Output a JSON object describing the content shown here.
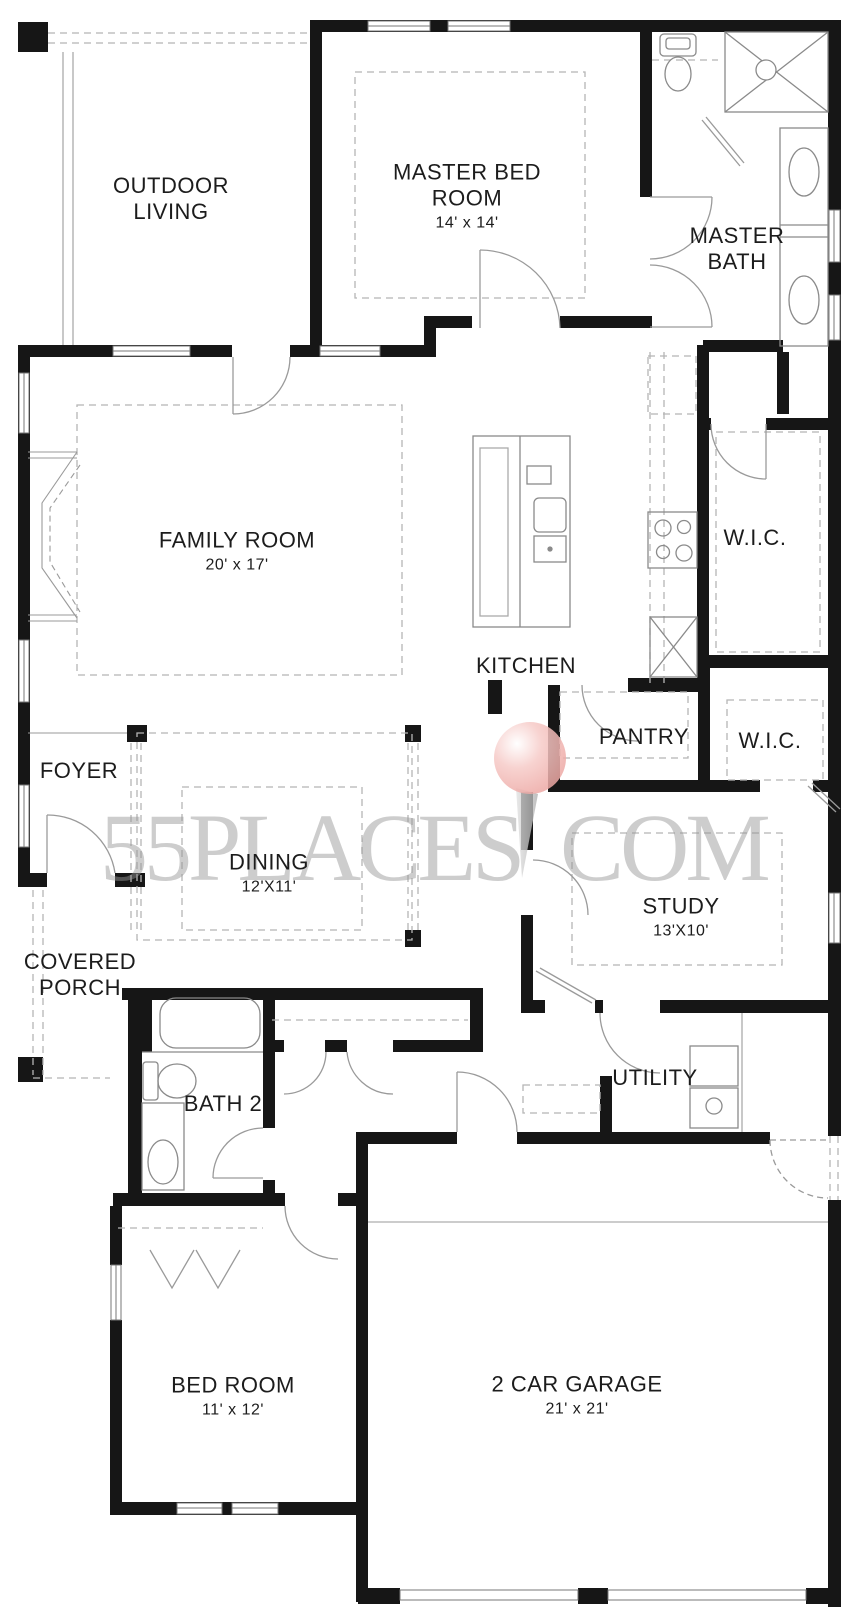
{
  "title": "Floor plan",
  "watermark": {
    "left": "55PLACES",
    "right": "COM",
    "pin_color": "#eda8a4"
  },
  "colors": {
    "wall": "#161616",
    "thin_line": "#8a8a8a",
    "dashed": "#b5b5b5",
    "label": "#1c1c1c",
    "watermark_gray": "#969696"
  },
  "rooms": [
    {
      "id": "outdoor-living",
      "name": "OUTDOOR LIVING",
      "dims": ""
    },
    {
      "id": "master-bedroom",
      "name": "MASTER BED ROOM",
      "dims": "14' x 14'"
    },
    {
      "id": "master-bath",
      "name": "MASTER BATH",
      "dims": ""
    },
    {
      "id": "family-room",
      "name": "FAMILY ROOM",
      "dims": "20' x 17'"
    },
    {
      "id": "kitchen",
      "name": "KITCHEN",
      "dims": ""
    },
    {
      "id": "wic-master",
      "name": "W.I.C.",
      "dims": ""
    },
    {
      "id": "foyer",
      "name": "FOYER",
      "dims": ""
    },
    {
      "id": "pantry",
      "name": "PANTRY",
      "dims": ""
    },
    {
      "id": "wic-study",
      "name": "W.I.C.",
      "dims": ""
    },
    {
      "id": "dining",
      "name": "DINING",
      "dims": "12'X11'"
    },
    {
      "id": "study",
      "name": "STUDY",
      "dims": "13'X10'"
    },
    {
      "id": "covered-porch",
      "name": "COVERED PORCH",
      "dims": ""
    },
    {
      "id": "bath-2",
      "name": "BATH 2",
      "dims": ""
    },
    {
      "id": "utility",
      "name": "UTILITY",
      "dims": ""
    },
    {
      "id": "bedroom-2",
      "name": "BED ROOM",
      "dims": "11' x 12'"
    },
    {
      "id": "garage",
      "name": "2 CAR GARAGE",
      "dims": "21' x 21'"
    }
  ]
}
